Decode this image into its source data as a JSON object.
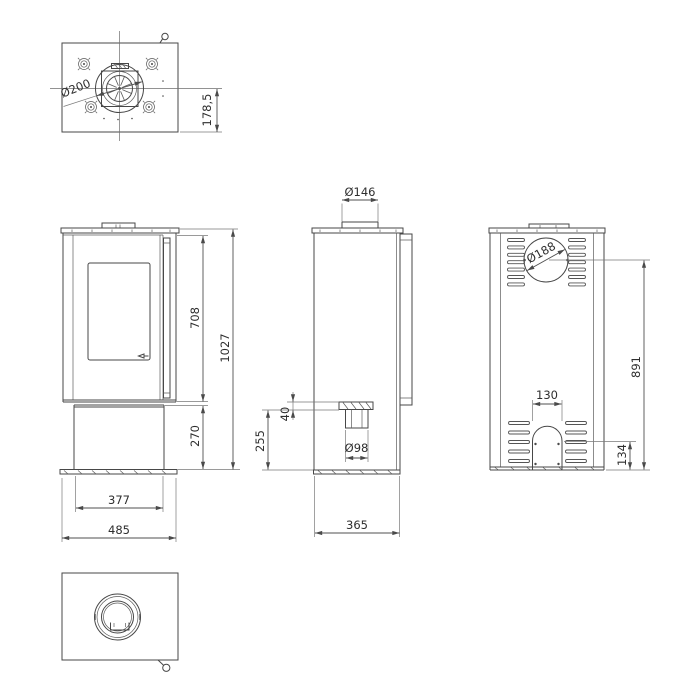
{
  "drawing": {
    "kind": "technical dimension drawing",
    "views": [
      "top",
      "front",
      "side",
      "back",
      "bottom"
    ],
    "line_color": "#474747",
    "background_color": "#ffffff"
  },
  "dimensions": {
    "top": {
      "flue_diameter": "Ø200",
      "flue_axis_offset": "178,5"
    },
    "front": {
      "upper_section_height": "708",
      "total_height": "1027",
      "base_height": "270",
      "inner_width": "377",
      "total_width": "485"
    },
    "side": {
      "top_flue_diameter": "Ø146",
      "inlet_collar_height": "40",
      "inlet_axis_height": "255",
      "air_inlet_diameter": "Ø98",
      "depth": "365"
    },
    "back": {
      "rear_flue_diameter": "Ø188",
      "rear_flue_axis_height": "891",
      "arch_width": "130",
      "arch_height": "134"
    }
  }
}
